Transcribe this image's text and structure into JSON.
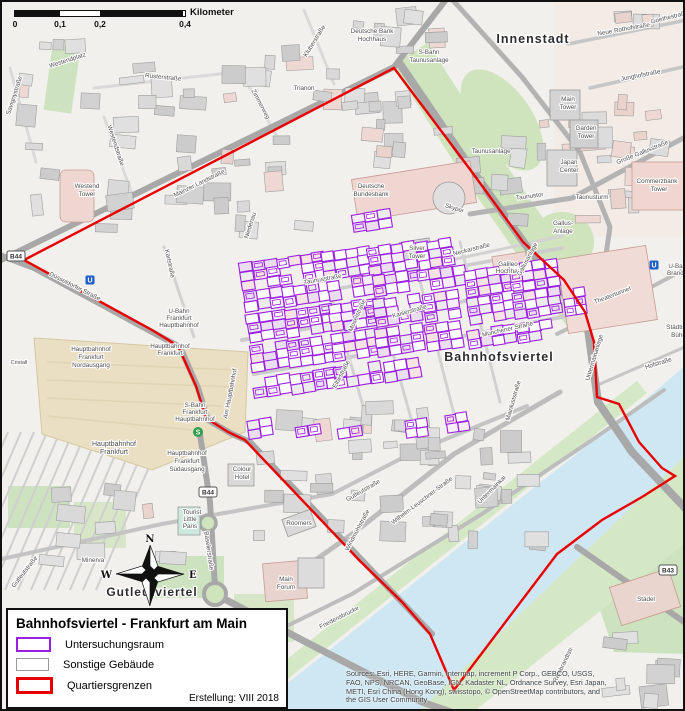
{
  "scalebar": {
    "ticks": [
      "0",
      "0,1",
      "0,2",
      "0,4"
    ],
    "unit": "Kilometer"
  },
  "compass": {
    "n": "N",
    "e": "E",
    "s": "S",
    "w": "W"
  },
  "legend": {
    "title": "Bahnhofsviertel - Frankfurt am Main",
    "items": [
      {
        "label": "Untersuchungsraum",
        "color": "#9b1fe0"
      },
      {
        "label": "Sonstige Gebäude",
        "color": "#9a9a9a"
      },
      {
        "label": "Quartiersgrenzen",
        "color": "#e80000"
      }
    ],
    "created": "Erstellung: VIII 2018"
  },
  "attribution": {
    "lines": [
      "Sources: Esri, HERE, Garmin, Intermap, increment P Corp., GEBCO, USGS,",
      "FAO, NPS, NRCAN, GeoBase, IGN, Kadaster NL, Ordnance Survey, Esri Japan,",
      "METI, Esri China (Hong Kong), swisstopo, © OpenStreetMap contributors, and",
      "the GIS User Community"
    ]
  },
  "colors": {
    "boundary": "#e80000",
    "study": "#9b1fe0",
    "water": "#cfe7f3",
    "green": "#cfe3bd",
    "road": "#ababab",
    "building": "#d9d9d9",
    "station": "#eadec3"
  },
  "shields": [
    {
      "t": "B44",
      "x": 14,
      "y": 254
    },
    {
      "t": "B44",
      "x": 206,
      "y": 490
    },
    {
      "t": "B43",
      "x": 666,
      "y": 568
    }
  ],
  "transit": [
    {
      "t": "U",
      "x": 88,
      "y": 278
    },
    {
      "t": "U",
      "x": 652,
      "y": 263
    },
    {
      "t": "S",
      "x": 196,
      "y": 430
    }
  ],
  "map": {
    "labels": [
      {
        "t": "Westendplatz",
        "x": 66,
        "y": 60,
        "r": -18
      },
      {
        "t": "Rüsterstraße",
        "x": 161,
        "y": 77,
        "r": 6
      },
      {
        "t": "Trianon",
        "x": 302,
        "y": 88
      },
      {
        "t": "Zimmerweg",
        "x": 257,
        "y": 103,
        "r": 62
      },
      {
        "t": "Kluberstraße",
        "x": 314,
        "y": 40,
        "r": -58
      },
      {
        "t": "Savignystraße",
        "x": 14,
        "y": 94,
        "r": -72
      },
      {
        "t": "Westendstraße",
        "x": 112,
        "y": 144,
        "r": 72
      },
      {
        "t": "Westend",
        "x": 85,
        "y": 186
      },
      {
        "t": "Tower",
        "x": 85,
        "y": 194
      },
      {
        "t": "Mainzer Landstraße",
        "x": 198,
        "y": 183,
        "r": -26
      },
      {
        "t": "Düsseldorfer Straße",
        "x": 72,
        "y": 286,
        "r": 27
      },
      {
        "t": "Karlstraße",
        "x": 166,
        "y": 262,
        "r": 78
      },
      {
        "t": "U-Bahn",
        "x": 177,
        "y": 311
      },
      {
        "t": "Frankfurt",
        "x": 177,
        "y": 318
      },
      {
        "t": "Hauptbahnhof",
        "x": 177,
        "y": 325
      },
      {
        "t": "Hauptbahnhof",
        "x": 168,
        "y": 346
      },
      {
        "t": "Frankfurt",
        "x": 168,
        "y": 353
      },
      {
        "t": "Hauptbahnhof",
        "x": 89,
        "y": 349
      },
      {
        "t": "Frankfurt",
        "x": 89,
        "y": 357
      },
      {
        "t": "Nordausgang",
        "x": 89,
        "y": 365
      },
      {
        "t": "S-Bahn",
        "x": 193,
        "y": 405
      },
      {
        "t": "Frankfurt",
        "x": 193,
        "y": 412
      },
      {
        "t": "Hauptbahnhof",
        "x": 193,
        "y": 419
      },
      {
        "t": "Hauptbahnhof",
        "x": 112,
        "y": 444,
        "s": 7
      },
      {
        "t": "Frankfurt",
        "x": 112,
        "y": 452,
        "s": 7
      },
      {
        "t": "Hauptbahnhof",
        "x": 185,
        "y": 453
      },
      {
        "t": "Frankfurt",
        "x": 185,
        "y": 461
      },
      {
        "t": "Südausgang",
        "x": 185,
        "y": 469
      },
      {
        "t": "Colour",
        "x": 240,
        "y": 469
      },
      {
        "t": "Hotel",
        "x": 240,
        "y": 477
      },
      {
        "t": "Tourist",
        "x": 190,
        "y": 512
      },
      {
        "t": "Little",
        "x": 188,
        "y": 519
      },
      {
        "t": "Paris",
        "x": 188,
        "y": 526
      },
      {
        "t": "Minerva",
        "x": 91,
        "y": 560
      },
      {
        "t": "Baselerstraße",
        "x": 205,
        "y": 549,
        "r": 82
      },
      {
        "t": "Gutleutstraße",
        "x": 24,
        "y": 571,
        "r": -52
      },
      {
        "t": "Cristall",
        "x": 17,
        "y": 362,
        "s": 5.5
      },
      {
        "t": "Deutsche Bank",
        "x": 370,
        "y": 31
      },
      {
        "t": "Hochhaus",
        "x": 370,
        "y": 39
      },
      {
        "t": "S-Bahn",
        "x": 427,
        "y": 52
      },
      {
        "t": "Taunusanlage",
        "x": 427,
        "y": 60
      },
      {
        "t": "Neue Rothofstraße",
        "x": 622,
        "y": 29,
        "r": -10
      },
      {
        "t": "Goethestraße",
        "x": 668,
        "y": 17,
        "r": -14
      },
      {
        "t": "Junghofstraße",
        "x": 639,
        "y": 75,
        "r": -11
      },
      {
        "t": "Main",
        "x": 566,
        "y": 99
      },
      {
        "t": "Tower",
        "x": 566,
        "y": 107
      },
      {
        "t": "Garden",
        "x": 584,
        "y": 128
      },
      {
        "t": "Tower",
        "x": 584,
        "y": 136
      },
      {
        "t": "Japan",
        "x": 567,
        "y": 162
      },
      {
        "t": "Center",
        "x": 567,
        "y": 170
      },
      {
        "t": "Taunusanlage",
        "x": 489,
        "y": 151
      },
      {
        "t": "Große Gallusstraße",
        "x": 641,
        "y": 152,
        "r": -22
      },
      {
        "t": "Commerzbank",
        "x": 655,
        "y": 181
      },
      {
        "t": "Tower",
        "x": 657,
        "y": 189
      },
      {
        "t": "Taunustor",
        "x": 528,
        "y": 196,
        "r": -8
      },
      {
        "t": "Taunusturm",
        "x": 590,
        "y": 197
      },
      {
        "t": "Gallus-",
        "x": 561,
        "y": 223
      },
      {
        "t": "Anlage",
        "x": 561,
        "y": 231
      },
      {
        "t": "Skyper",
        "x": 452,
        "y": 208,
        "r": 18
      },
      {
        "t": "Deutsche",
        "x": 369,
        "y": 186
      },
      {
        "t": "Bundesbank",
        "x": 369,
        "y": 194
      },
      {
        "t": "Silver",
        "x": 415,
        "y": 248
      },
      {
        "t": "Tower",
        "x": 415,
        "y": 256
      },
      {
        "t": "Neckarstraße",
        "x": 470,
        "y": 249,
        "r": -14
      },
      {
        "t": "Galileo",
        "x": 506,
        "y": 264
      },
      {
        "t": "Hochhaus",
        "x": 508,
        "y": 271
      },
      {
        "t": "Gallusanlage",
        "x": 527,
        "y": 258,
        "r": -62
      },
      {
        "t": "Münchener Straße",
        "x": 506,
        "y": 329,
        "r": -13
      },
      {
        "t": "Theatertunnel",
        "x": 611,
        "y": 295,
        "r": -21
      },
      {
        "t": "U-Bahn",
        "x": 677,
        "y": 266
      },
      {
        "t": "Brandt-Pl.",
        "x": 679,
        "y": 273
      },
      {
        "t": "Städtische",
        "x": 679,
        "y": 327
      },
      {
        "t": "Bühnen",
        "x": 680,
        "y": 335
      },
      {
        "t": "Hofstraße",
        "x": 657,
        "y": 363,
        "r": -18
      },
      {
        "t": "Untermainanlage",
        "x": 594,
        "y": 356,
        "r": -73
      },
      {
        "t": "Kaiserstraße",
        "x": 408,
        "y": 311,
        "r": -16
      },
      {
        "t": "Taunusstraße",
        "x": 321,
        "y": 279,
        "r": -10
      },
      {
        "t": "Moselstraße",
        "x": 357,
        "y": 314,
        "r": -66
      },
      {
        "t": "Elbestraße",
        "x": 341,
        "y": 373,
        "r": -62
      },
      {
        "t": "Am Hauptbahnhof",
        "x": 230,
        "y": 392,
        "r": -79
      },
      {
        "t": "Niedenau",
        "x": 250,
        "y": 224,
        "r": -72
      },
      {
        "t": "Mainluststraße",
        "x": 513,
        "y": 399,
        "r": -74
      },
      {
        "t": "Windmühlstraße",
        "x": 357,
        "y": 529,
        "r": -62
      },
      {
        "t": "Wilhelm-Leuschner-Straße",
        "x": 421,
        "y": 500,
        "r": -37
      },
      {
        "t": "Gutleutstraße",
        "x": 362,
        "y": 490,
        "r": -30
      },
      {
        "t": "Roomers",
        "x": 297,
        "y": 523
      },
      {
        "t": "Untermainkai",
        "x": 491,
        "y": 489,
        "r": -45
      },
      {
        "t": "Main",
        "x": 284,
        "y": 579
      },
      {
        "t": "Forum",
        "x": 284,
        "y": 587
      },
      {
        "t": "Friedensbrücke",
        "x": 338,
        "y": 617,
        "r": -27
      },
      {
        "t": "Städel",
        "x": 644,
        "y": 599
      },
      {
        "t": "Rembrandtstr.",
        "x": 563,
        "y": 663,
        "r": -64
      },
      {
        "t": "Innenstadt",
        "x": 531,
        "y": 41,
        "b": 1,
        "s": 12.5
      },
      {
        "t": "Bahnhofsviertel",
        "x": 497,
        "y": 359,
        "b": 1,
        "s": 12.5
      },
      {
        "t": "Gutleutviertel",
        "x": 150,
        "y": 594,
        "b": 1,
        "s": 12
      }
    ]
  }
}
